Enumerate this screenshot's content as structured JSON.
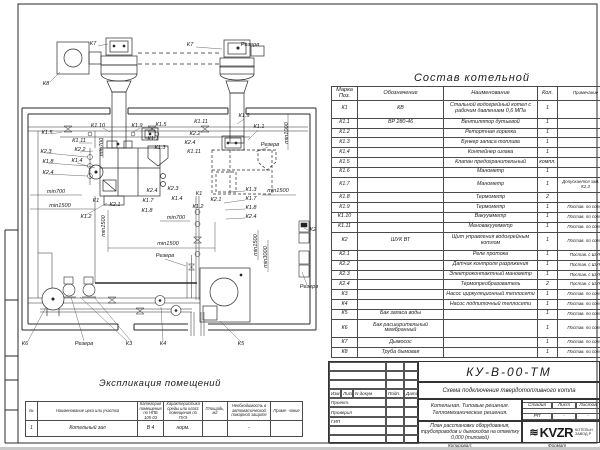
{
  "colors": {
    "ink": "#1f1f1f",
    "paper": "#ffffff"
  },
  "spec_table": {
    "title": "Состав котельной",
    "col_headers": [
      "Марка Поз.",
      "Обозначение",
      "Наименование",
      "Кол.",
      "Примечание"
    ],
    "rows": [
      [
        "К1",
        "КВ",
        "Стальной водогрейный котел с рабочим давлением 0,6 МПа",
        "1",
        ""
      ],
      [
        "К1.1",
        "ВР 280-46",
        "Вентилятор дутьевой",
        "1",
        ""
      ],
      [
        "К1.2",
        "",
        "Ретортная горелка",
        "1",
        ""
      ],
      [
        "К1.3",
        "",
        "Бункер запаса топлива",
        "1",
        ""
      ],
      [
        "К1.4",
        "",
        "Контейнер шлака",
        "1",
        ""
      ],
      [
        "К1.5",
        "",
        "Клапан предохранительный",
        "компл.",
        ""
      ],
      [
        "К1.6",
        "",
        "Манометр",
        "1",
        ""
      ],
      [
        "К1.7",
        "",
        "Манометр",
        "1",
        "Допускается зам. поз. К2.3"
      ],
      [
        "К1.8",
        "",
        "Термометр",
        "2",
        ""
      ],
      [
        "К1.9",
        "",
        "Термометр",
        "1",
        "Постав. по согла"
      ],
      [
        "К1.10",
        "",
        "Вакуумметр",
        "1",
        "Постав. по согла"
      ],
      [
        "К1.11",
        "",
        "Мановакуумметр",
        "1",
        "Постав. по согла"
      ],
      [
        "К2",
        "ШУК ВТ",
        "Щит управления водогрейным котлом",
        "1",
        "Постав. по согла"
      ],
      [
        "К2.1",
        "",
        "Реле протока",
        "1",
        "Постав. с ШУК"
      ],
      [
        "К2.2",
        "",
        "Датчик контроля разряжения",
        "1",
        "Постав. с ШУК"
      ],
      [
        "К2.3",
        "",
        "Электроконтактный манометр",
        "1",
        "Постав. с ШУК"
      ],
      [
        "К2.4",
        "",
        "Термопреобразователь",
        "2",
        "Постав. с ШУК"
      ],
      [
        "К3",
        "",
        "Насос циркуляционный теплосети",
        "1",
        "Постав. по согла"
      ],
      [
        "К4",
        "",
        "Насос подпиточный теплосети",
        "1",
        "Постав. по согла"
      ],
      [
        "К5",
        "Бак запаса воды",
        "",
        "1",
        "Постав. по согла"
      ],
      [
        "К6",
        "Бак расширительный мембранный",
        "",
        "1",
        "Постав. по согла"
      ],
      [
        "К7",
        "Дымосос",
        "",
        "1",
        "Постав. по согла"
      ],
      [
        "К8",
        "Труба дымовая",
        "",
        "1",
        "Постав. по согла"
      ]
    ]
  },
  "explication": {
    "title": "Экспликация помещений",
    "col_headers": [
      "№",
      "Наименование цеха или участка",
      "Категория помещения по НПБ 105-03",
      "Характеристика среды или класс помещения по ПУЭ",
      "Площадь, м2",
      "Необходимость в автоматической пожарной защите",
      "Приме- чание"
    ],
    "rows": [
      [
        "1",
        "Котельный зал",
        "В 4",
        "норм.",
        "",
        "-",
        ""
      ]
    ]
  },
  "title_block": {
    "doc_number": "КУ-В-00-ТМ",
    "doc_title": "Схема подключения твердотопливного котла",
    "sig_headers": [
      "Изм",
      "Лист",
      "N докум",
      "Подп.",
      "Дата"
    ],
    "roles": [
      "Проект.",
      "Проверил",
      "ГИП"
    ],
    "object_line_1": "Котельная. Типовые решения.",
    "object_line_2": "Тепломеханические решения.",
    "stage_headers": [
      "Стадия",
      "Лист",
      "Листов"
    ],
    "stage_values": [
      "РП",
      "-",
      "-"
    ],
    "sheet_title": "План расстановки оборудования, трубопроводов и дымоходов на отметку 0,000 (типовой)",
    "logo_text": "KVZR",
    "logo_wave": "≋",
    "logo_caption_1": "КОТЕЛЬН",
    "logo_caption_2": "ЗАВОД Р",
    "footer_left": "Копировал:",
    "footer_right": "Формат"
  },
  "schematic": {
    "labels": [
      {
        "t": "К7",
        "x": 93,
        "y": 45
      },
      {
        "t": "К7",
        "x": 190,
        "y": 46
      },
      {
        "t": "Резерв",
        "x": 250,
        "y": 46
      },
      {
        "t": "К8",
        "x": 46,
        "y": 85
      },
      {
        "t": "К1.5",
        "x": 47,
        "y": 134
      },
      {
        "t": "К1.10",
        "x": 98,
        "y": 127
      },
      {
        "t": "К1.9",
        "x": 137,
        "y": 127
      },
      {
        "t": "К1.5",
        "x": 161,
        "y": 126
      },
      {
        "t": "К1.11",
        "x": 201,
        "y": 123
      },
      {
        "t": "К2.2",
        "x": 195,
        "y": 135
      },
      {
        "t": "К2.4",
        "x": 190,
        "y": 144
      },
      {
        "t": "К1.11",
        "x": 194,
        "y": 153
      },
      {
        "t": "К1.1",
        "x": 153,
        "y": 140
      },
      {
        "t": "К1.3",
        "x": 160,
        "y": 149
      },
      {
        "t": "К1.9",
        "x": 244,
        "y": 117
      },
      {
        "t": "К1.1",
        "x": 259,
        "y": 128
      },
      {
        "t": "Резерв",
        "x": 270,
        "y": 146
      },
      {
        "t": "К1.11",
        "x": 79,
        "y": 142
      },
      {
        "t": "К2.2",
        "x": 80,
        "y": 151
      },
      {
        "t": "К1.4",
        "x": 77,
        "y": 162
      },
      {
        "t": "К2.3",
        "x": 46,
        "y": 153
      },
      {
        "t": "К1.8",
        "x": 48,
        "y": 163
      },
      {
        "t": "К2.4",
        "x": 48,
        "y": 174
      },
      {
        "t": "min700",
        "x": 103,
        "y": 147,
        "r": -90
      },
      {
        "t": "min700",
        "x": 56,
        "y": 193
      },
      {
        "t": "min1500",
        "x": 60,
        "y": 207
      },
      {
        "t": "К1",
        "x": 96,
        "y": 202
      },
      {
        "t": "К2.1",
        "x": 115,
        "y": 206
      },
      {
        "t": "К1.2",
        "x": 86,
        "y": 218
      },
      {
        "t": "К2.4",
        "x": 152,
        "y": 192
      },
      {
        "t": "К1.7",
        "x": 148,
        "y": 202
      },
      {
        "t": "К1.8",
        "x": 147,
        "y": 212
      },
      {
        "t": "К2.3",
        "x": 173,
        "y": 190
      },
      {
        "t": "К1.4",
        "x": 177,
        "y": 200
      },
      {
        "t": "min700",
        "x": 176,
        "y": 219
      },
      {
        "t": "К1",
        "x": 199,
        "y": 195
      },
      {
        "t": "К2.1",
        "x": 216,
        "y": 201
      },
      {
        "t": "К1.2",
        "x": 198,
        "y": 208
      },
      {
        "t": "К1.3",
        "x": 251,
        "y": 191
      },
      {
        "t": "К1.7",
        "x": 251,
        "y": 200
      },
      {
        "t": "К1.8",
        "x": 251,
        "y": 209
      },
      {
        "t": "К2.4",
        "x": 251,
        "y": 218
      },
      {
        "t": "min1500",
        "x": 278,
        "y": 192
      },
      {
        "t": "min1000",
        "x": 288,
        "y": 133,
        "r": -90
      },
      {
        "t": "min1500",
        "x": 105,
        "y": 226,
        "r": -90
      },
      {
        "t": "min1500",
        "x": 168,
        "y": 245
      },
      {
        "t": "Резерв",
        "x": 165,
        "y": 257
      },
      {
        "t": "min1500",
        "x": 257,
        "y": 245,
        "r": -90
      },
      {
        "t": "min3000",
        "x": 267,
        "y": 257,
        "r": -90
      },
      {
        "t": "К2",
        "x": 313,
        "y": 231
      },
      {
        "t": "Резерв",
        "x": 309,
        "y": 288
      },
      {
        "t": "К6",
        "x": 25,
        "y": 345
      },
      {
        "t": "Резерв",
        "x": 84,
        "y": 345
      },
      {
        "t": "К3",
        "x": 129,
        "y": 345
      },
      {
        "t": "К4",
        "x": 163,
        "y": 345
      },
      {
        "t": "К5",
        "x": 241,
        "y": 345
      }
    ]
  }
}
